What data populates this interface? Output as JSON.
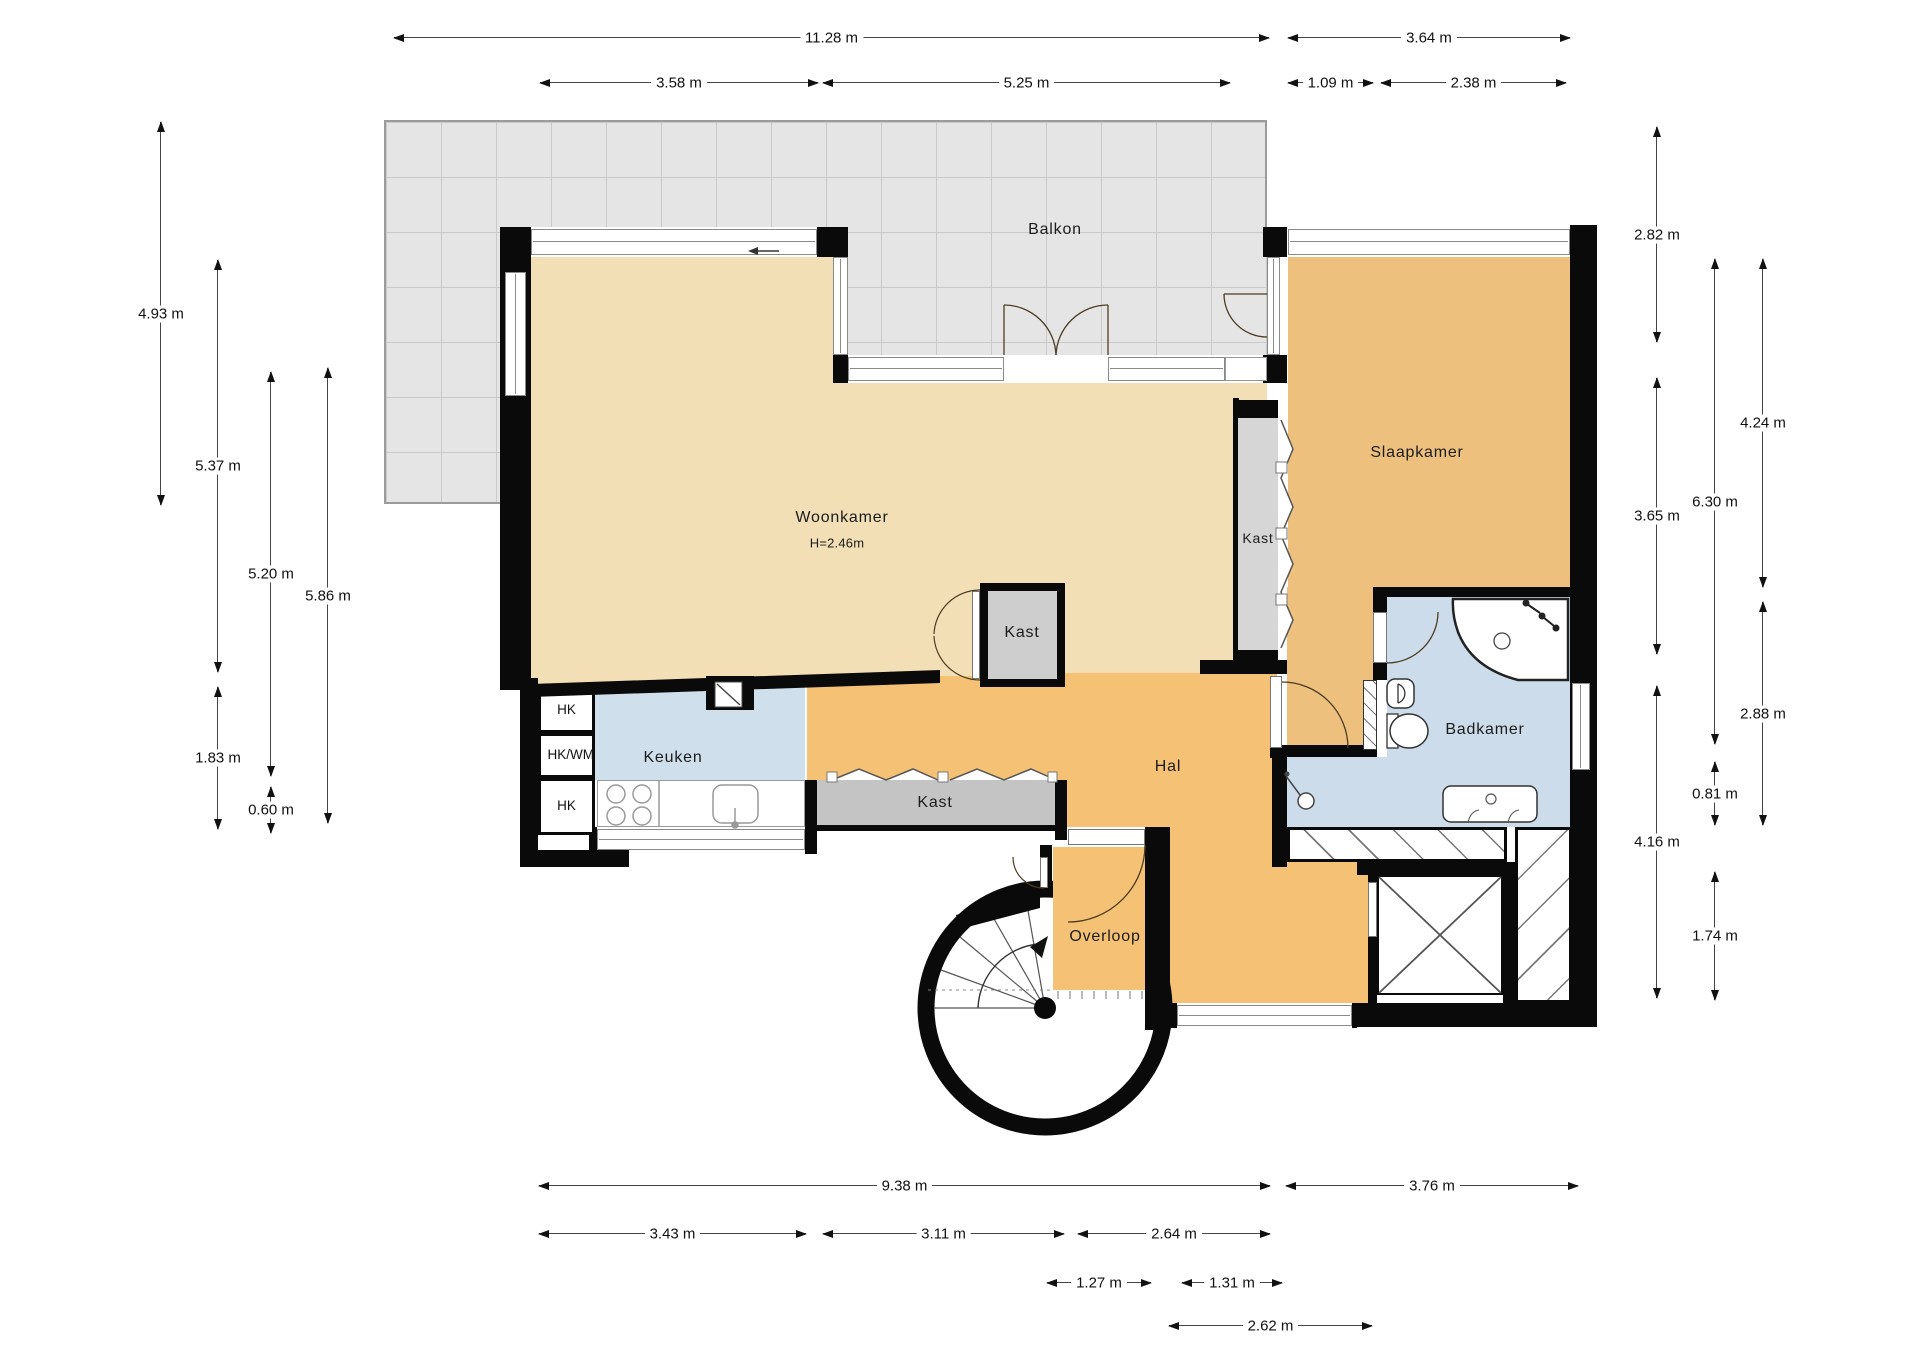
{
  "plan_type": "floor-plan",
  "rooms": {
    "balkon": "Balkon",
    "woonkamer": "Woonkamer",
    "woonkamer_height": "H=2.46m",
    "slaapkamer": "Slaapkamer",
    "keuken": "Keuken",
    "hal": "Hal",
    "badkamer": "Badkamer",
    "overloop": "Overloop",
    "kast": "Kast",
    "hk": "HK",
    "hk_wm": "HK/WM"
  },
  "dimensions": {
    "top": [
      "11.28 m",
      "3.64 m",
      "3.58 m",
      "5.25 m",
      "1.09 m",
      "2.38 m"
    ],
    "left": [
      "4.93 m",
      "5.37 m",
      "5.20 m",
      "5.86 m",
      "1.83 m",
      "0.60 m"
    ],
    "right": [
      "2.82 m",
      "3.65 m",
      "4.16 m",
      "6.30 m",
      "0.81 m",
      "1.74 m",
      "4.24 m",
      "2.88 m"
    ],
    "bottom": [
      "9.38 m",
      "3.76 m",
      "3.43 m",
      "3.11 m",
      "2.64 m",
      "1.27 m",
      "1.31 m",
      "2.62 m"
    ]
  },
  "colors": {
    "wall": "#0a0a0a",
    "balcony_tile": "#e5e5e5",
    "balcony_grid": "#c9c9c9",
    "woonkamer": "#f2dfb6",
    "slaapkamer": "#edc07e",
    "hal_overloop": "#f5c175",
    "keuken": "#cfdfec",
    "badkamer": "#cddcea",
    "kast": "#cecece",
    "dimension_text": "#111111"
  }
}
